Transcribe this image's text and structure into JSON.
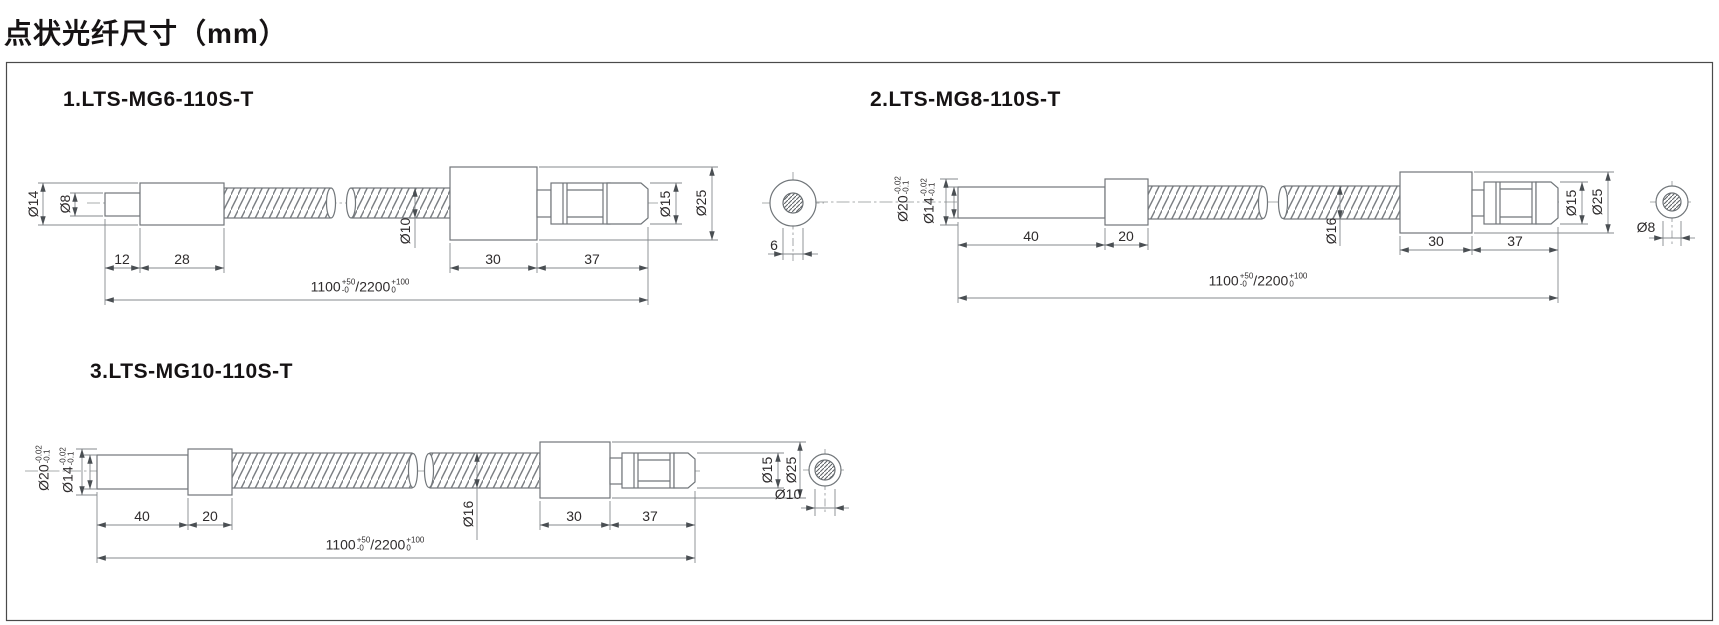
{
  "page": {
    "title": "点状光纤尺寸（mm）"
  },
  "drawings": [
    {
      "title": "1.LTS-MG6-110S-T",
      "dims": {
        "body_dia": "Ø14",
        "tip_dia": "Ø8",
        "tip_len": "12",
        "body_len": "28",
        "conduit_dia": "Ø10",
        "block_len": "30",
        "connector_len": "37",
        "connector_dia": "Ø15",
        "block_dia": "Ø25",
        "core_dia": "6"
      },
      "overall": {
        "len1": "1100",
        "tol1_up": "+50",
        "tol1_dn": "-0",
        "sep": "/",
        "len2": "2200",
        "tol2_up": "+100",
        "tol2_dn": "0"
      }
    },
    {
      "title": "2.LTS-MG8-110S-T",
      "dims": {
        "head_dia": "Ø20",
        "head_tol_up": "-0.02",
        "head_tol_dn": "-0.1",
        "tip_dia": "Ø14",
        "tip_tol_up": "-0.02",
        "tip_tol_dn": "-0.1",
        "tip_len": "40",
        "collar_len": "20",
        "conduit_dia": "Ø16",
        "block_len": "30",
        "connector_len": "37",
        "connector_dia": "Ø15",
        "block_dia": "Ø25",
        "core_dia": "Ø8"
      },
      "overall": {
        "len1": "1100",
        "tol1_up": "+50",
        "tol1_dn": "-0",
        "sep": "/",
        "len2": "2200",
        "tol2_up": "+100",
        "tol2_dn": "0"
      }
    },
    {
      "title": "3.LTS-MG10-110S-T",
      "dims": {
        "head_dia": "Ø20",
        "head_tol_up": "-0.02",
        "head_tol_dn": "-0.1",
        "tip_dia": "Ø14",
        "tip_tol_up": "-0.02",
        "tip_tol_dn": "-0.1",
        "tip_len": "40",
        "collar_len": "20",
        "conduit_dia": "Ø16",
        "block_len": "30",
        "connector_len": "37",
        "connector_dia": "Ø15",
        "block_dia": "Ø25",
        "core_dia": "Ø10"
      },
      "overall": {
        "len1": "1100",
        "tol1_up": "+50",
        "tol1_dn": "-0",
        "sep": "/",
        "len2": "2200",
        "tol2_up": "+100",
        "tol2_dn": "0"
      }
    }
  ]
}
